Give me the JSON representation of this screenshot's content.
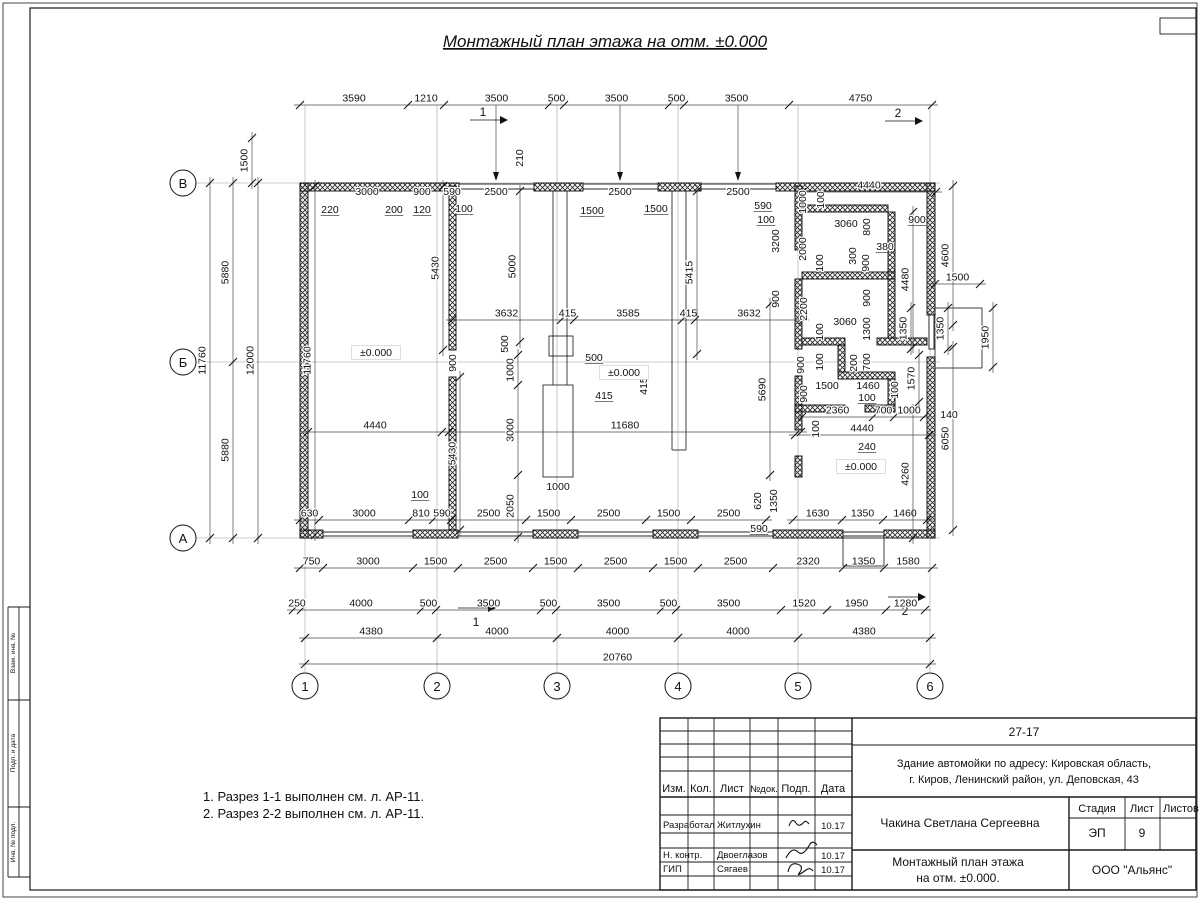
{
  "sheet": {
    "title": "Монтажный план этажа на отм. ±0.000"
  },
  "notes": {
    "line1": "1. Разрез 1-1 выполнен см. л. АР-11.",
    "line2": "2. Разрез 2-2 выполнен см. л. АР-11."
  },
  "axes": {
    "cols": [
      "1",
      "2",
      "3",
      "4",
      "5",
      "6"
    ],
    "rows": [
      "В",
      "Б",
      "А"
    ]
  },
  "section_marks": {
    "s1": "1",
    "s2": "2"
  },
  "frame": {
    "stamp_labels": [
      "Взам. инв. №",
      "Подп. и дата",
      "Инв. № подл."
    ]
  },
  "title_block": {
    "doc_number": "27-17",
    "address_line1": "Здание автомойки по адресу: Кировская область,",
    "address_line2": "г. Киров, Ленинский район, ул. Деповская, 43",
    "col_izm": "Изм.",
    "col_kol": "Кол.",
    "col_list": "Лист",
    "col_ndoc": "№док.",
    "col_podp": "Подп.",
    "col_data": "Дата",
    "rows": [
      {
        "role": "Разработал",
        "name": "Житлухин",
        "date": "10.17"
      },
      {
        "role": "Н. контр.",
        "name": "Двоеглазов",
        "date": "10.17"
      },
      {
        "role": "ГИП",
        "name": "Сягаев",
        "date": "10.17"
      }
    ],
    "author": "Чакина Светлана Сергеевна",
    "stage_label": "Стадия",
    "sheet_label": "Лист",
    "sheets_label": "Листов",
    "stage_value": "ЭП",
    "sheet_value": "9",
    "drawing_title_line1": "Монтажный план этажа",
    "drawing_title_line2": "на отм. ±0.000.",
    "company": "ООО \"Альянс\""
  },
  "plan": {
    "chains": [
      {
        "d": "h",
        "y": 105,
        "x": [
          300,
          408,
          444,
          549,
          564,
          669,
          684,
          789,
          932
        ],
        "l": [
          "3590",
          "1210",
          "3500",
          "500",
          "3500",
          "500",
          "3500",
          "4750"
        ]
      },
      {
        "d": "v",
        "x": 210,
        "y": [
          183,
          538
        ],
        "l": [
          "11760"
        ]
      },
      {
        "d": "v",
        "x": 233,
        "y": [
          183,
          362,
          538
        ],
        "l": [
          "5880",
          "5880"
        ]
      },
      {
        "d": "v",
        "x": 258,
        "y": [
          183,
          538
        ],
        "l": [
          "12000"
        ]
      },
      {
        "d": "v",
        "x": 252,
        "y": [
          138,
          183
        ],
        "l": [
          "1500"
        ]
      },
      {
        "d": "v",
        "x": 315,
        "y": [
          186,
          535
        ],
        "l": [
          "11760"
        ]
      },
      {
        "d": "h",
        "y": 520,
        "x": [
          300,
          319,
          409,
          433,
          451,
          526,
          571,
          646,
          691,
          766
        ],
        "l": [
          "630",
          "3000",
          "810",
          "590",
          "2500",
          "1500",
          "2500",
          "1500",
          "2500"
        ]
      },
      {
        "d": "h",
        "y": 520,
        "x": [
          793,
          842,
          883,
          927
        ],
        "l": [
          "1630",
          "1350",
          "1460"
        ]
      },
      {
        "d": "h",
        "y": 568,
        "x": [
          300,
          323,
          413,
          458,
          533,
          578,
          653,
          698,
          773,
          843,
          884,
          932
        ],
        "l": [
          "750",
          "3000",
          "1500",
          "2500",
          "1500",
          "2500",
          "1500",
          "2500",
          "2320",
          "1350",
          "1580"
        ]
      },
      {
        "d": "h",
        "y": 610,
        "x": [
          293,
          301,
          421,
          436,
          541,
          556,
          661,
          676,
          781,
          827,
          886,
          925
        ],
        "l": [
          "250",
          "4000",
          "500",
          "3500",
          "500",
          "3500",
          "500",
          "3500",
          "1520",
          "1950",
          "1280"
        ]
      },
      {
        "d": "h",
        "y": 638,
        "x": [
          305,
          437,
          557,
          678,
          798,
          930
        ],
        "l": [
          "4380",
          "4000",
          "4000",
          "4000",
          "4380"
        ]
      },
      {
        "d": "h",
        "y": 664,
        "x": [
          305,
          930
        ],
        "l": [
          "20760"
        ]
      },
      {
        "d": "h",
        "y": 320,
        "x": [
          452,
          561,
          574,
          682,
          695,
          803
        ],
        "l": [
          "3632",
          "415",
          "3585",
          "415",
          "3632"
        ]
      },
      {
        "d": "h",
        "y": 432,
        "x": [
          308,
          442
        ],
        "l": [
          "4440"
        ]
      },
      {
        "d": "h",
        "y": 432,
        "x": [
          449,
          801
        ],
        "l": [
          "11680"
        ]
      },
      {
        "d": "v",
        "x": 518,
        "y": [
          355,
          385,
          475,
          537
        ],
        "l": [
          "1000",
          "3000",
          "2050"
        ]
      },
      {
        "d": "v",
        "x": 443,
        "y": [
          186,
          350
        ],
        "l": [
          "5430"
        ]
      },
      {
        "d": "v",
        "x": 460,
        "y": [
          377,
          530
        ],
        "l": [
          "5430"
        ]
      },
      {
        "d": "v",
        "x": 520,
        "y": [
          191,
          342
        ],
        "l": [
          "5000"
        ]
      },
      {
        "d": "v",
        "x": 697,
        "y": [
          191,
          354
        ],
        "l": [
          "5415"
        ]
      },
      {
        "d": "v",
        "x": 770,
        "y": [
          304,
          475
        ],
        "l": [
          "5690"
        ]
      },
      {
        "d": "v",
        "x": 953,
        "y": [
          186,
          325
        ],
        "l": [
          "4600"
        ]
      },
      {
        "d": "v",
        "x": 913,
        "y": [
          212,
          347
        ],
        "l": [
          "4480"
        ]
      },
      {
        "d": "v",
        "x": 953,
        "y": [
          347,
          530
        ],
        "l": [
          "6050"
        ]
      },
      {
        "d": "v",
        "x": 913,
        "y": [
          410,
          538
        ],
        "l": [
          "4260"
        ]
      },
      {
        "d": "v",
        "x": 911,
        "y": [
          308,
          349
        ],
        "l": [
          "1350"
        ]
      },
      {
        "d": "v",
        "x": 948,
        "y": [
          308,
          349
        ],
        "l": [
          "1350"
        ]
      },
      {
        "d": "v",
        "x": 993,
        "y": [
          308,
          367
        ],
        "l": [
          "1950"
        ]
      },
      {
        "d": "h",
        "y": 284,
        "x": [
          935,
          980
        ],
        "l": [
          "1500"
        ]
      },
      {
        "d": "h",
        "y": 192,
        "x": [
          802,
          936
        ],
        "l": [
          "4440"
        ]
      },
      {
        "d": "h",
        "y": 417,
        "x": [
          802,
          873,
          894,
          924
        ],
        "l": [
          "2360",
          "700",
          "1000"
        ]
      },
      {
        "d": "h",
        "y": 435,
        "x": [
          795,
          929
        ],
        "l": [
          "4440"
        ]
      },
      {
        "d": "v",
        "x": 919,
        "y": [
          355,
          402
        ],
        "l": [
          "1570"
        ]
      }
    ],
    "dim_labels": [
      {
        "t": "3000",
        "x": 367,
        "y": 195
      },
      {
        "t": "900",
        "x": 422,
        "y": 195
      },
      {
        "t": "590",
        "x": 452,
        "y": 195
      },
      {
        "t": "2500",
        "x": 496,
        "y": 195
      },
      {
        "t": "2500",
        "x": 620,
        "y": 195
      },
      {
        "t": "2500",
        "x": 738,
        "y": 195
      },
      {
        "t": "220",
        "x": 330,
        "y": 213,
        "u": 1
      },
      {
        "t": "200",
        "x": 394,
        "y": 213,
        "u": 1
      },
      {
        "t": "120",
        "x": 422,
        "y": 213,
        "u": 1
      },
      {
        "t": "100",
        "x": 464,
        "y": 212,
        "u": 1
      },
      {
        "t": "1500",
        "x": 592,
        "y": 214,
        "u": 1
      },
      {
        "t": "1500",
        "x": 656,
        "y": 212,
        "u": 1
      },
      {
        "t": "590",
        "x": 763,
        "y": 209,
        "u": 1
      },
      {
        "t": "100",
        "x": 766,
        "y": 223,
        "u": 1
      },
      {
        "t": "210",
        "x": 523,
        "y": 158,
        "r": 1
      },
      {
        "t": "500",
        "x": 508,
        "y": 344,
        "r": 1
      },
      {
        "t": "500",
        "x": 594,
        "y": 361,
        "u": 1
      },
      {
        "t": "415",
        "x": 604,
        "y": 399,
        "u": 1
      },
      {
        "t": "415",
        "x": 647,
        "y": 386,
        "r": 1
      },
      {
        "t": "900",
        "x": 456,
        "y": 363,
        "r": 1
      },
      {
        "t": "100",
        "x": 420,
        "y": 498,
        "u": 1
      },
      {
        "t": "1000",
        "x": 558,
        "y": 490
      },
      {
        "t": "±0.000",
        "x": 376,
        "y": 356,
        "b": 1
      },
      {
        "t": "±0.000",
        "x": 624,
        "y": 376,
        "b": 1
      },
      {
        "t": "±0.000",
        "x": 861,
        "y": 470,
        "b": 1
      },
      {
        "t": "1000",
        "x": 806,
        "y": 202,
        "r": 1
      },
      {
        "t": "100",
        "x": 824,
        "y": 200,
        "r": 1
      },
      {
        "t": "3060",
        "x": 846,
        "y": 227
      },
      {
        "t": "800",
        "x": 870,
        "y": 227,
        "r": 1
      },
      {
        "t": "900",
        "x": 917,
        "y": 223,
        "u": 1
      },
      {
        "t": "2000",
        "x": 806,
        "y": 249,
        "r": 1
      },
      {
        "t": "380",
        "x": 885,
        "y": 250,
        "u": 1
      },
      {
        "t": "300",
        "x": 856,
        "y": 256,
        "r": 1
      },
      {
        "t": "900",
        "x": 869,
        "y": 263,
        "r": 1
      },
      {
        "t": "100",
        "x": 823,
        "y": 263,
        "r": 1
      },
      {
        "t": "3200",
        "x": 779,
        "y": 241,
        "r": 1
      },
      {
        "t": "900",
        "x": 779,
        "y": 299,
        "r": 1
      },
      {
        "t": "2200",
        "x": 807,
        "y": 309,
        "r": 1
      },
      {
        "t": "900",
        "x": 870,
        "y": 298,
        "r": 1
      },
      {
        "t": "3060",
        "x": 845,
        "y": 325
      },
      {
        "t": "1300",
        "x": 870,
        "y": 329,
        "r": 1
      },
      {
        "t": "100",
        "x": 823,
        "y": 332,
        "r": 1
      },
      {
        "t": "100",
        "x": 823,
        "y": 362,
        "r": 1
      },
      {
        "t": "200",
        "x": 857,
        "y": 363,
        "r": 1
      },
      {
        "t": "700",
        "x": 870,
        "y": 362,
        "r": 1
      },
      {
        "t": "900",
        "x": 804,
        "y": 365,
        "r": 1
      },
      {
        "t": "1500",
        "x": 827,
        "y": 389
      },
      {
        "t": "1460",
        "x": 868,
        "y": 389
      },
      {
        "t": "100",
        "x": 898,
        "y": 390,
        "r": 1
      },
      {
        "t": "100",
        "x": 867,
        "y": 401,
        "u": 1
      },
      {
        "t": "900",
        "x": 807,
        "y": 394,
        "r": 1
      },
      {
        "t": "140",
        "x": 949,
        "y": 418
      },
      {
        "t": "240",
        "x": 867,
        "y": 450,
        "u": 1
      },
      {
        "t": "100",
        "x": 819,
        "y": 429,
        "r": 1
      },
      {
        "t": "620",
        "x": 761,
        "y": 501,
        "r": 1
      },
      {
        "t": "1350",
        "x": 777,
        "y": 501,
        "r": 1
      },
      {
        "t": "590",
        "x": 759,
        "y": 532,
        "u": 1
      }
    ]
  }
}
